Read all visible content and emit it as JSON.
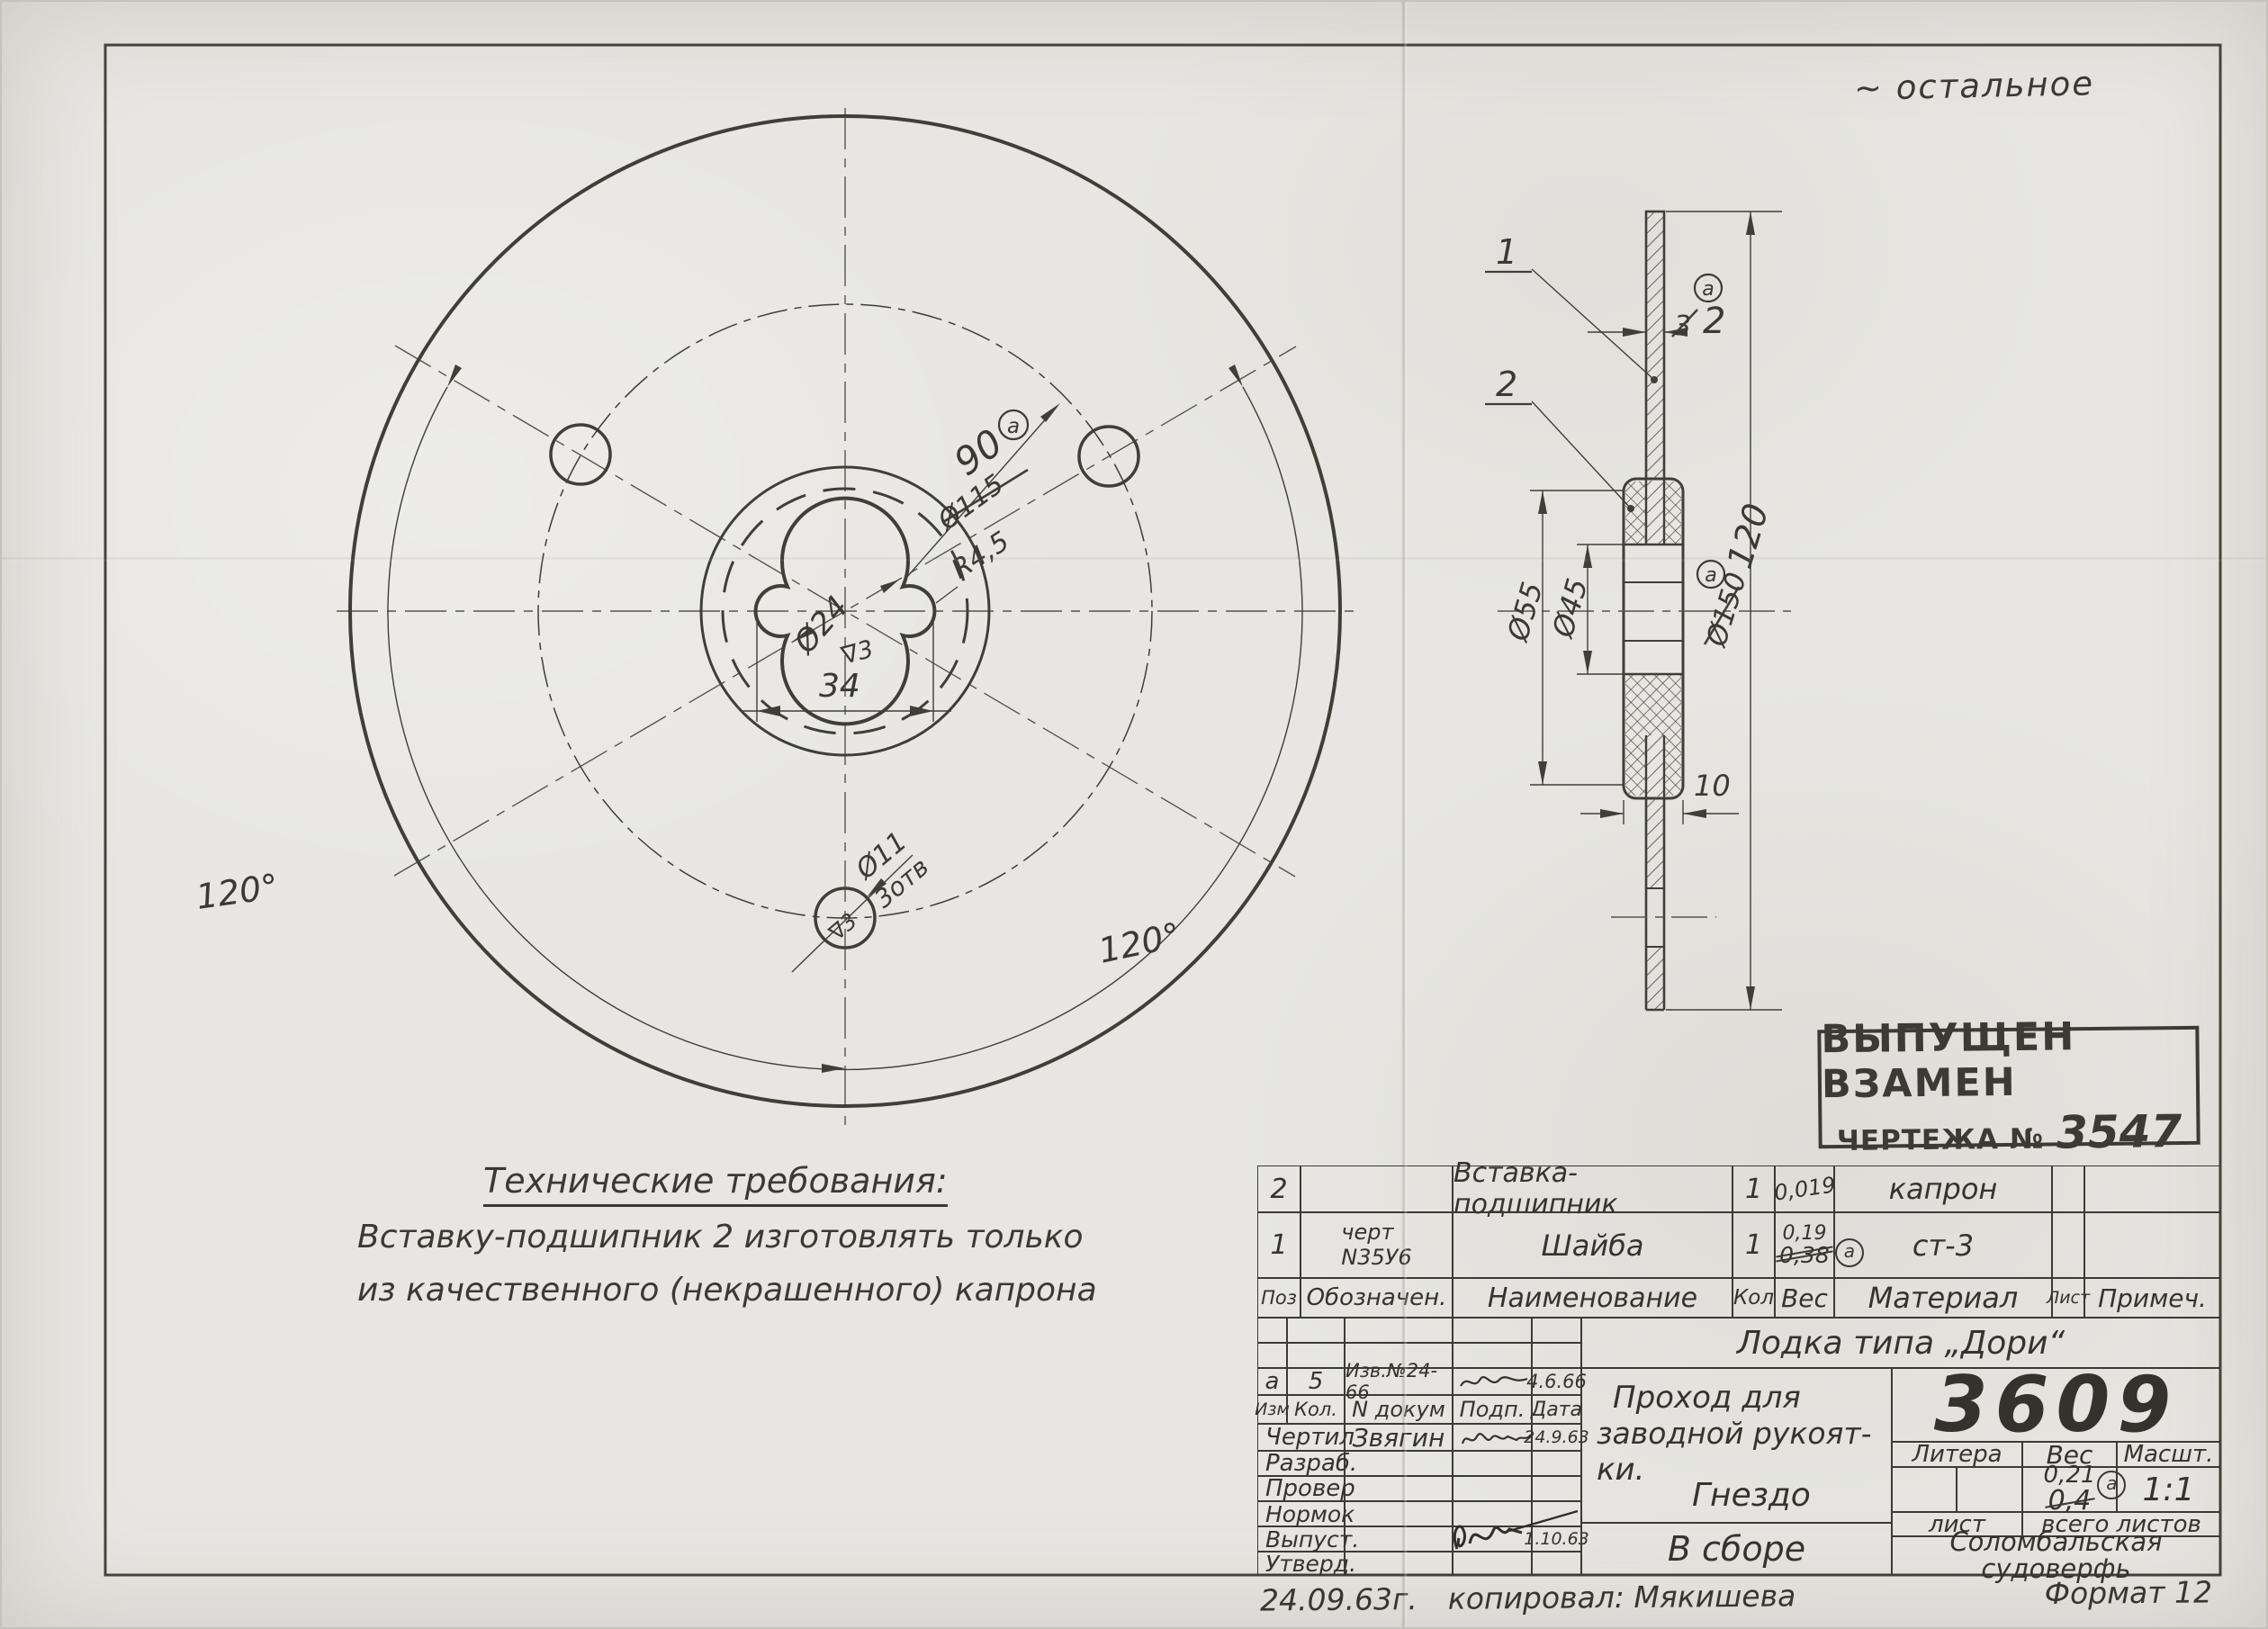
{
  "sheet": {
    "surface_note": "~ остальное",
    "bottom_note": {
      "date": "24.09.63г.",
      "copied": "копировал:  Мякишева",
      "format": "Формат 12"
    }
  },
  "stamp": {
    "line1": "ВЫПУЩЕН ВЗАМЕН",
    "line2_prefix": "ЧЕРТЕЖА №",
    "line2_number": "3547"
  },
  "tech_requirements": {
    "heading": "Технические требования:",
    "line1": "Вставку-подшипник 2  изготовлять только",
    "line2": "из  качественного (некрашенного) капрона"
  },
  "left_view": {
    "angle_left": "120°",
    "angle_right": "120°",
    "bolt_circle_new": "90",
    "bolt_circle_old": "Ø115",
    "rev_mark": "а",
    "radius": "R4,5",
    "center_dia": "Ø24",
    "finish_center": "∇3",
    "width": "34",
    "hole_dia": "Ø11",
    "hole_count": "3отв",
    "finish_hole": "∇3"
  },
  "section_view": {
    "item1": "1",
    "item2": "2",
    "thickness_new": "2",
    "thickness_old": "3",
    "rev_mark": "а",
    "dia_outer_insert": "Ø55",
    "dia_bore": "Ø45",
    "dia_old": "Ø150",
    "dia_new": "120",
    "insert_width": "10"
  },
  "parts_table": {
    "headers": [
      "Поз",
      "Обозначен.",
      "Наименование",
      "Кол",
      "Вес",
      "Материал",
      "Лист",
      "Примеч."
    ],
    "rows": [
      {
        "pos": "2",
        "designation": "",
        "name": "Вставка-подшипник",
        "qty": "1",
        "weight": "0,019",
        "material": "капрон",
        "sheet": "",
        "note": ""
      },
      {
        "pos": "1",
        "designation_line1": "черт",
        "designation_line2": "N35У6",
        "name": "Шайба",
        "qty": "1",
        "weight_new": "0,19",
        "weight_old": "0,38",
        "rev_mark": "а",
        "material": "ст-3",
        "sheet": "",
        "note": ""
      }
    ]
  },
  "title_block": {
    "project": "Лодка типа „Дори“",
    "drawing_number": "3609",
    "rev_row": {
      "izm": "а",
      "kol": "5",
      "doc": "Изв.№24-66",
      "date": "4.6.66"
    },
    "sig_headers": [
      "Изм",
      "Кол.",
      "N докум",
      "Подп.",
      "Дата"
    ],
    "sig_rows": [
      {
        "role": "Чертил",
        "name": "Звягин",
        "date": "24.9.63"
      },
      {
        "role": "Разраб.",
        "name": "",
        "date": ""
      },
      {
        "role": "Провер",
        "name": "",
        "date": ""
      },
      {
        "role": "Нормок",
        "name": "",
        "date": ""
      },
      {
        "role": "Выпуст.",
        "name": "",
        "date": "1.10.63"
      },
      {
        "role": "Утверд.",
        "name": "",
        "date": ""
      }
    ],
    "desc_line1": "Проход для",
    "desc_line2": "заводной рукоят-",
    "desc_line3": "ки.",
    "desc_line4": "Гнездо",
    "assembly": "В сборе",
    "litera_headers": [
      "Литера",
      "Вес",
      "Масшт."
    ],
    "weight_new": "0,21",
    "weight_old": "0,4",
    "weight_rev": "а",
    "scale": "1:1",
    "sheet_label": "лист",
    "total_sheets_label": "всего листов",
    "factory_line1": "Соломбальская",
    "factory_line2": "судоверфь"
  }
}
